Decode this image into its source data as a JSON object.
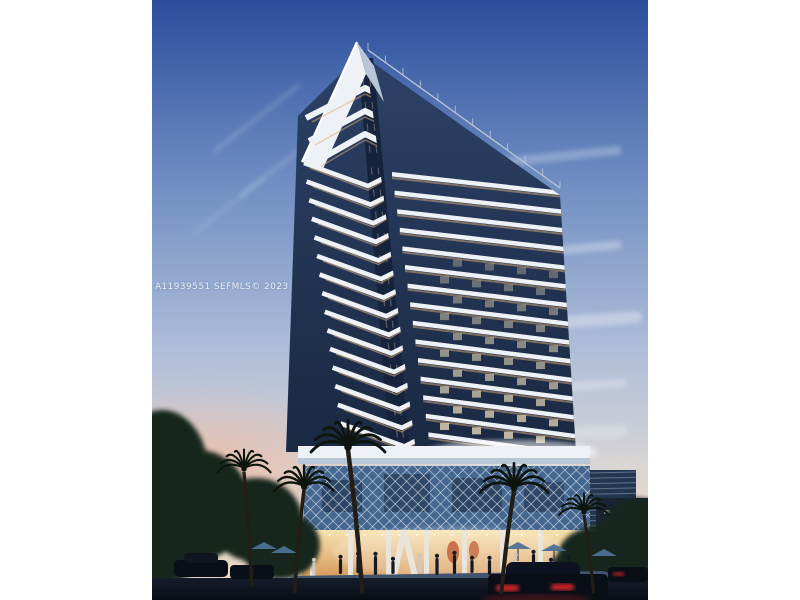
{
  "photo": {
    "watermark": "A11939551 SEFMLS© 2023",
    "description": "Dusk architectural rendering of a high-rise condominium tower with stacked white chevron balconies, an illuminated retail podium with lattice screen, palm trees, pedestrians and cars on the street",
    "time_of_day": "dusk"
  },
  "colors": {
    "sky_top": "#2a4d9c",
    "sky_mid": "#6f8dc2",
    "sky_low": "#aebdd9",
    "sky_haze": "#d8d5d6",
    "horizon_warm": "#e9d8c6",
    "sunset_pink": "#efb9a0",
    "cloud": "#ffffff",
    "glass_dark": "#1a2942",
    "glass_mid": "#2c4166",
    "glass_corner": "#15233c",
    "slab_white": "#eef2f7",
    "slab_shade": "#b9c6d6",
    "warm_glow": "#ddae77",
    "window_lit": "#f4e4c0",
    "lattice_bg": "#44668f",
    "lattice_line": "#dde6ef",
    "louver_bg": "#24364f",
    "louver_line": "#8fa6bd",
    "storefront_top": "#f7e2b0",
    "storefront_bottom": "#d99d5f",
    "column_white": "#e9e5da",
    "art_orange": "#c2603a",
    "sidewalk": "#42536d",
    "street": "#151c2a",
    "street_dark": "#090d15",
    "foliage": "#16251b",
    "palm": "#0c140d",
    "trunk": "#221d17",
    "car_body": "#0a0e16",
    "taillight": "#de262c",
    "umbrella": "#4c7193",
    "people": "#141a22"
  },
  "scene": {
    "tower_floor_count": 18,
    "crown_chevron_count": 3,
    "body_floor_count": 15,
    "railing_post_count": 12,
    "palm_count": 5,
    "people_count": 14,
    "umbrella_count": 5,
    "car_count": 4,
    "ceiling_light_count": 16
  }
}
